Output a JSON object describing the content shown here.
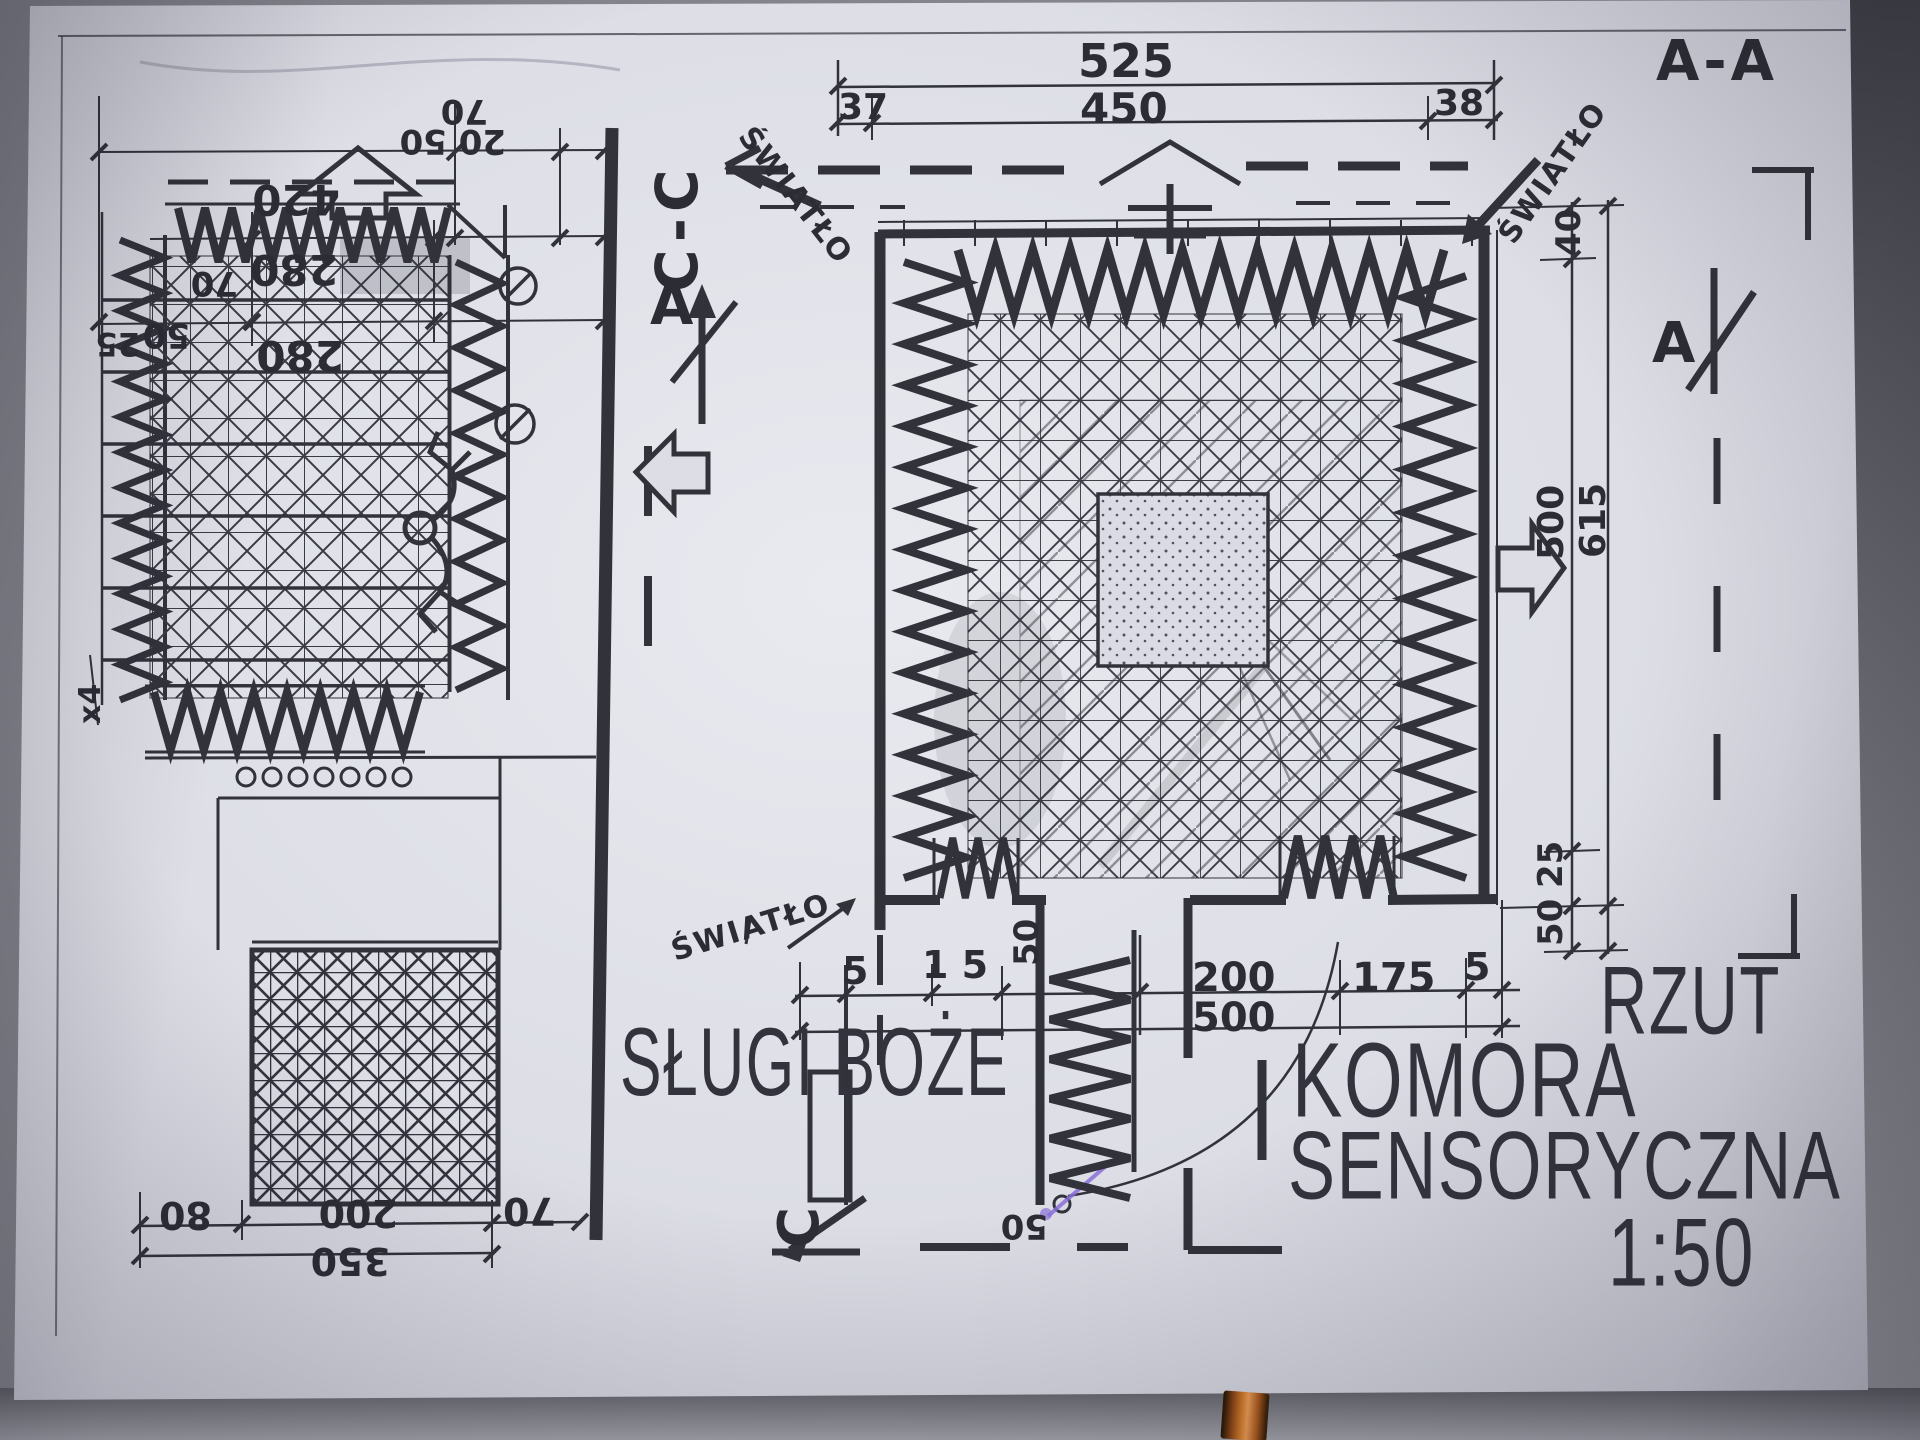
{
  "labels": {
    "slugi_boze": "SŁUGI BOŻE",
    "komora": "KOMORA",
    "sensoryczna": "SENSORYCZNA",
    "scale": "1:50",
    "rzut": "RZUT",
    "section_aa": "A-A",
    "section_cc": "C-C",
    "marker_a": "A",
    "marker_c": "C",
    "swiatlo": "ŚWIATŁO",
    "note_x4": "x4"
  },
  "dims": {
    "plan_top": {
      "total": "525",
      "inner": "450",
      "left": "37",
      "right": "38"
    },
    "plan_right": {
      "top": "40",
      "inner": "500",
      "total": "615",
      "lower_a": "50",
      "lower_b": "25"
    },
    "plan_bottom": {
      "left": "5",
      "pair": "1 5",
      "corridor": "50",
      "opening": "200",
      "right_opening": "175",
      "right": "5",
      "total": "500",
      "door": "50"
    },
    "section_top": {
      "total": "420",
      "mid": "280",
      "low": "280",
      "left_a": "70",
      "left_b": "50",
      "left_c": "25",
      "right_a": "70",
      "right_b": "20 50"
    },
    "section_bottom": {
      "a": "80",
      "b": "200",
      "c": "70",
      "total": "350"
    }
  }
}
